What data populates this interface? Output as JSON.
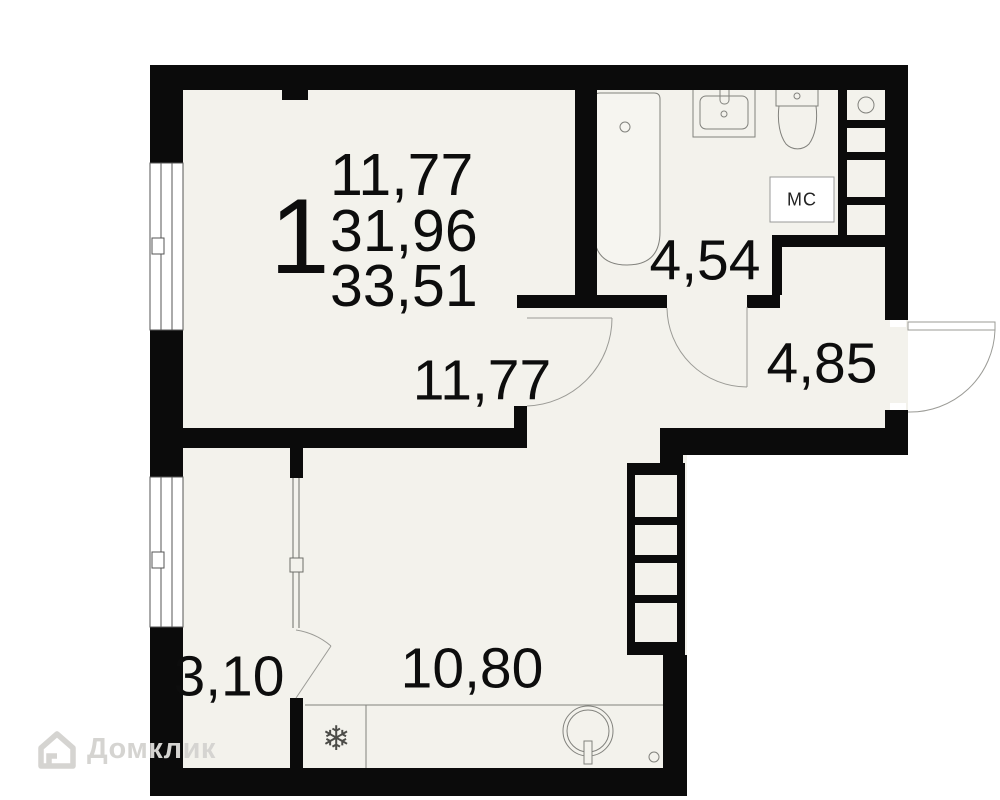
{
  "apartment": {
    "number": "1",
    "stacked_areas": {
      "line1": "11,77",
      "line2": "31,96",
      "line3": "33,51"
    }
  },
  "rooms": {
    "living": {
      "area": "11,77"
    },
    "bathroom": {
      "area": "4,54"
    },
    "hallway": {
      "area": "4,85"
    },
    "balcony": {
      "area": "3,10"
    },
    "kitchen": {
      "area": "10,80"
    }
  },
  "fixtures": {
    "washing_machine_label": "МС",
    "fridge_icon": "❄"
  },
  "watermark": {
    "brand": "Домклик"
  },
  "colors": {
    "wall": "#0b0b0b",
    "floor": "#f3f2ec",
    "fixture_line": "#82827d",
    "door_arc": "#9b9b96",
    "text": "#0d0d0d",
    "washer_box_bg": "#ffffff",
    "watermark": "#d5d4d1"
  }
}
